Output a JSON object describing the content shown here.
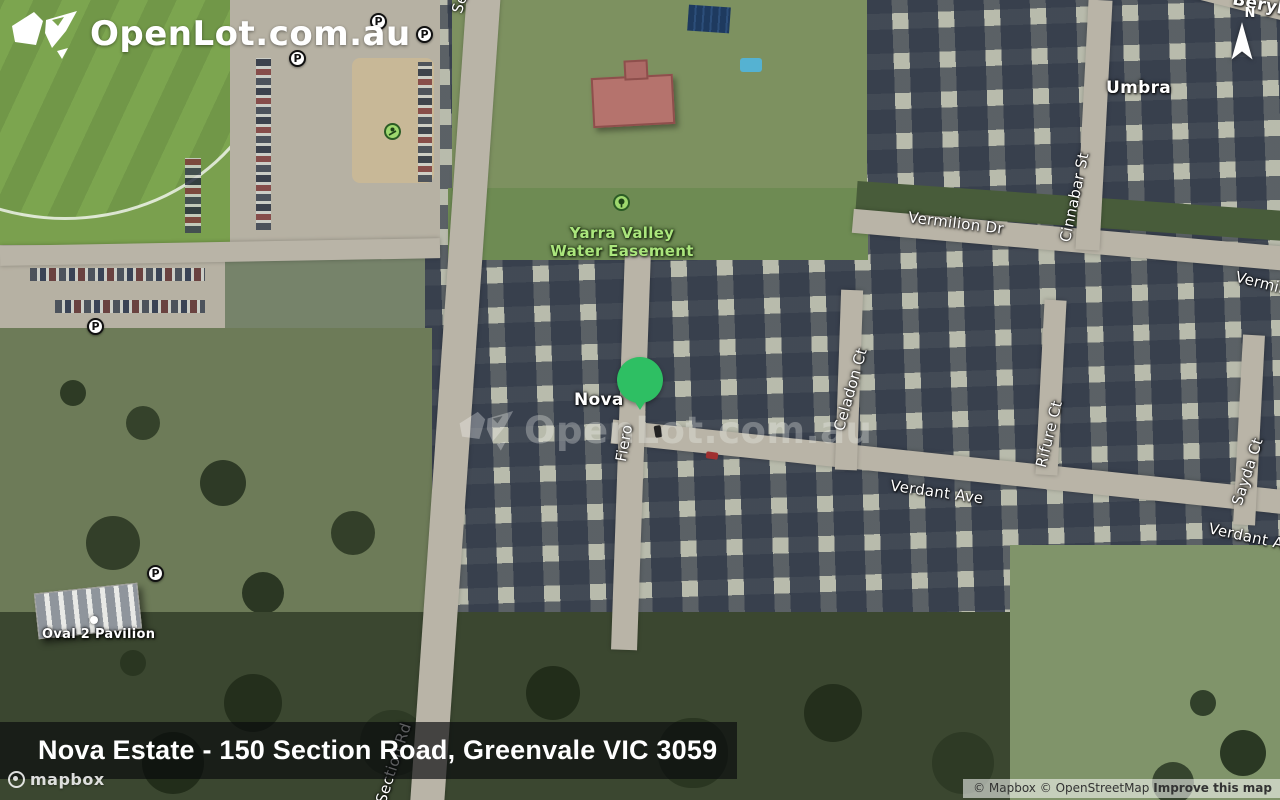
{
  "brand": {
    "logo_text": "OpenLot.com.au"
  },
  "watermark": {
    "text": "OpenLot.com.au"
  },
  "compass": {
    "north_label": "N"
  },
  "map_labels": {
    "section_road_top": "Section",
    "section_road_bottom": "Section Rd",
    "beryl_street": "Beryl C",
    "umbra": "Umbra",
    "cinnabar_street": "Cinnabar St",
    "vermilion_drive": "Vermilion Dr",
    "vermilion_drive_edge": "Vermili",
    "yarra_easement_line1": "Yarra Valley",
    "yarra_easement_line2": "Water Easement",
    "nova": "Nova",
    "fiero_street": "Fiero",
    "celadon_court": "Celadon Ct",
    "rifure_court": "Rifure Ct",
    "sayda_court": "Sayda Ct",
    "verdant_avenue": "Verdant Ave",
    "verdant_avenue_edge": "Verdant Av",
    "oval_pavilion": "Oval 2 Pavilion",
    "parking_symbol": "P"
  },
  "marker": {
    "color": "#2ebf63"
  },
  "colors": {
    "easement_text": "#abe67d",
    "marker_green": "#2ebf63"
  },
  "footer": {
    "title": "Nova Estate - 150 Section Road, Greenvale VIC 3059"
  },
  "mapbox": {
    "logo_text": "mapbox"
  },
  "attribution": {
    "mapbox": "© Mapbox",
    "osm": "© OpenStreetMap",
    "improve": "Improve this map"
  }
}
